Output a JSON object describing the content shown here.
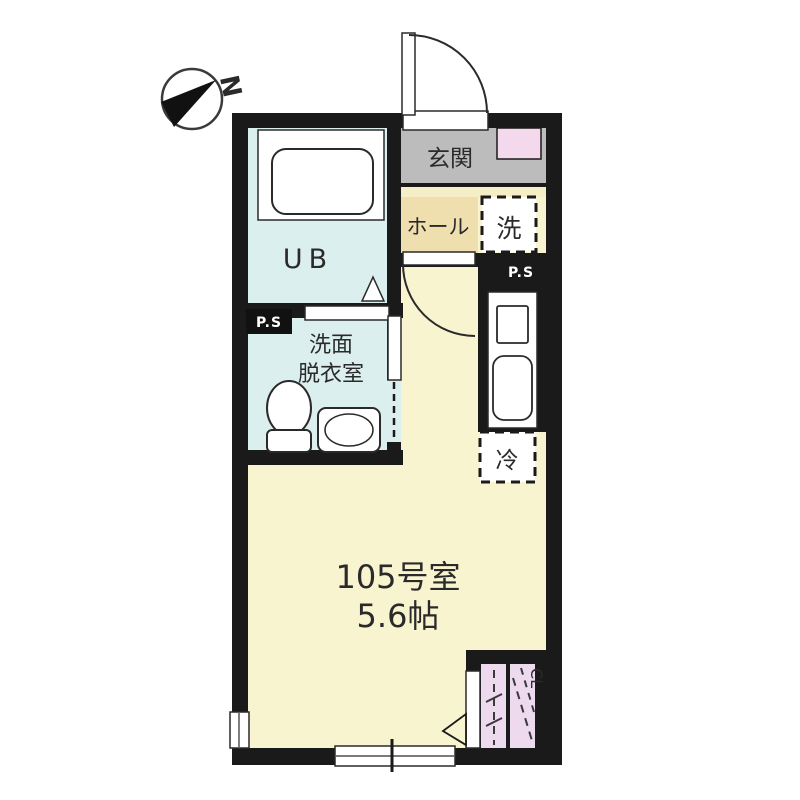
{
  "title": "apartment-floorplan",
  "compass": {
    "north_label": "N"
  },
  "rooms": {
    "entrance": {
      "label": "玄関"
    },
    "hall": {
      "label": "ホール"
    },
    "washer": {
      "label": "洗"
    },
    "unit_bath": {
      "label": "UB"
    },
    "washroom": {
      "label_line1": "洗面",
      "label_line2": "脱衣室"
    },
    "refrigerator": {
      "label": "冷"
    },
    "main_room": {
      "name": "105号室",
      "size": "5.6帖"
    },
    "closet": {
      "label": "CL"
    },
    "pipe_space_1": {
      "label": "P.S"
    },
    "pipe_space_2": {
      "label": "P.S"
    }
  },
  "colors": {
    "background": "#ffffff",
    "wall": "#1a1a1a",
    "room_cream": "#f8f4cf",
    "step_cream": "#f5eec6",
    "hall_tan": "#f0dfae",
    "entrance_gray": "#bcbcbc",
    "bath_blue": "#dcefef",
    "pink": "#f4d9ec",
    "closet_pink": "#eedaef"
  }
}
